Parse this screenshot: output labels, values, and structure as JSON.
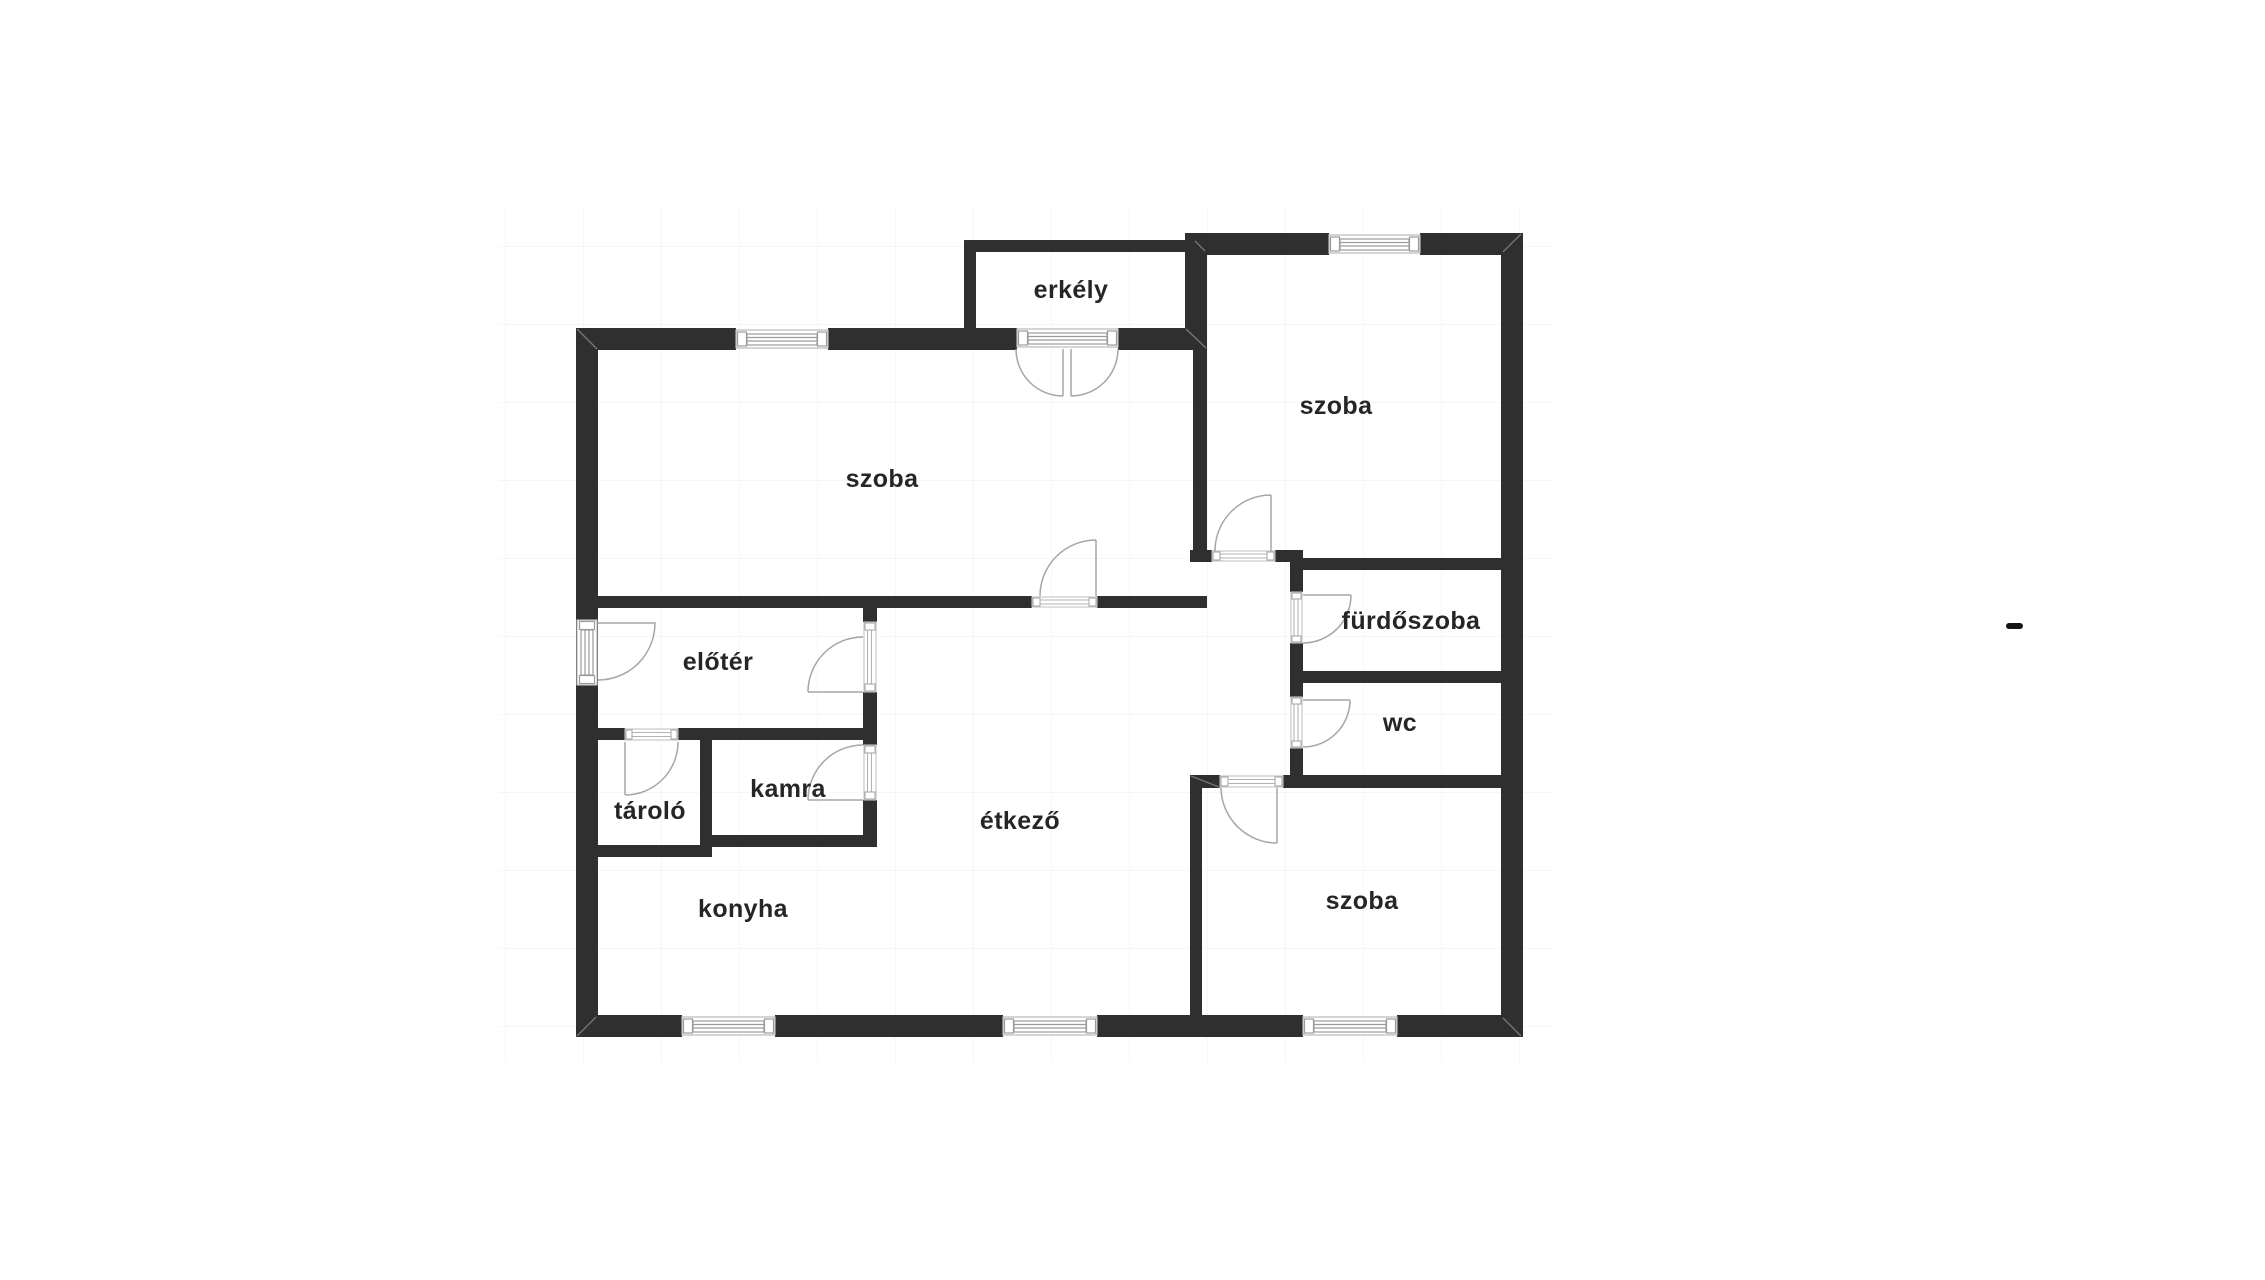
{
  "figure": {
    "kind": "floorplan",
    "language": "hungarian"
  },
  "colors": {
    "background": "#ffffff",
    "wall": "#2f2f2f",
    "grid_line": "#f0f0f0",
    "door_arc": "#a6a6a6",
    "window_frame": "#9b9b9b",
    "label": "#262626",
    "dash_mark": "#151515"
  },
  "rooms": [
    {
      "id": "szoba-large",
      "label": "szoba"
    },
    {
      "id": "szoba-top-right",
      "label": "szoba"
    },
    {
      "id": "szoba-bottom-right",
      "label": "szoba"
    },
    {
      "id": "erkely",
      "label": "erkély"
    },
    {
      "id": "furdoszoba",
      "label": "fürdőszoba"
    },
    {
      "id": "wc",
      "label": "wc"
    },
    {
      "id": "etkezo",
      "label": "étkező"
    },
    {
      "id": "konyha",
      "label": "konyha"
    },
    {
      "id": "eloter",
      "label": "előtér"
    },
    {
      "id": "tarolo",
      "label": "tároló"
    },
    {
      "id": "kamra",
      "label": "kamra"
    }
  ],
  "marks": {
    "dash": "-"
  }
}
